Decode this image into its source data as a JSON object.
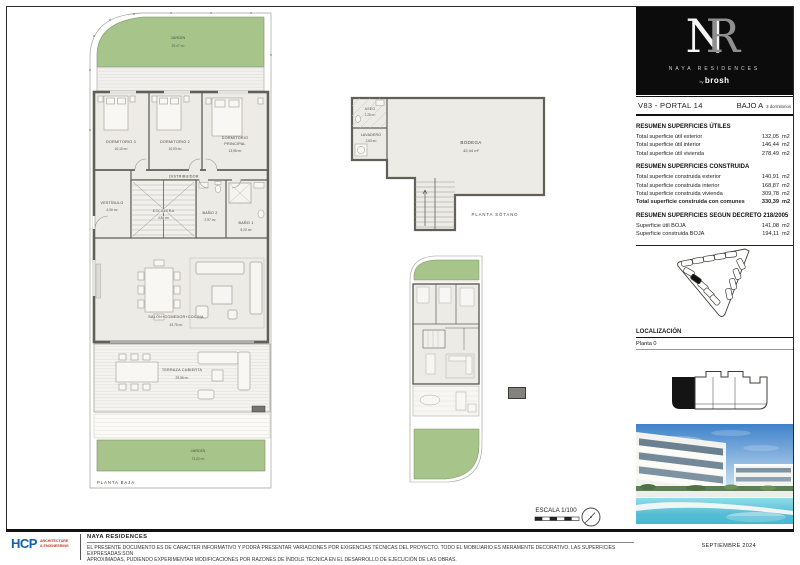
{
  "logo": {
    "monogram_n": "N",
    "monogram_r": "R",
    "brand": "NAYA RESIDENCES",
    "by": "by",
    "studio": "brosh"
  },
  "header": {
    "unit": "V83 - PORTAL 14",
    "floor": "BAJO A",
    "bedrooms": "3 dormitorios"
  },
  "tables": [
    {
      "title": "RESUMEN SUPERFICIES ÚTILES",
      "rows": [
        {
          "label": "Total superficie útil exterior",
          "value": "132,05",
          "unit": "m2"
        },
        {
          "label": "Total superficie útil interior",
          "value": "146,44",
          "unit": "m2"
        },
        {
          "label": "Total superficie útil vivienda",
          "value": "278,49",
          "unit": "m2"
        }
      ]
    },
    {
      "title": "RESUMEN SUPERFICIES CONSTRUIDA",
      "rows": [
        {
          "label": "Total superficie construida exterior",
          "value": "140,91",
          "unit": "m2"
        },
        {
          "label": "Total superficie construida interior",
          "value": "168,87",
          "unit": "m2"
        },
        {
          "label": "Total superficie construida vivienda",
          "value": "309,78",
          "unit": "m2"
        },
        {
          "label": "Total superficie construida con comunes",
          "value": "330,39",
          "unit": "m2"
        }
      ]
    },
    {
      "title": "RESUMEN SUPERFICIES SEGUN DECRETO 218/2005",
      "rows": [
        {
          "label": "Superficie útil BOJA",
          "value": "141,08",
          "unit": "m2"
        },
        {
          "label": "Superficie construida BOJA",
          "value": "194,11",
          "unit": "m2"
        }
      ]
    }
  ],
  "location": {
    "title": "LOCALIZACIÓN",
    "floor": "Planta  0"
  },
  "ground_floor": {
    "label": "PLANTA BAJA",
    "rooms": {
      "jardin_top": {
        "name": "JARDÍN",
        "area": "29,47 m²"
      },
      "dormitorio3": {
        "name": "DORMITORIO 3",
        "area": "10,10 m²"
      },
      "dormitorio2": {
        "name": "DORMITORIO 2",
        "area": "10,03 m²"
      },
      "dormitorio_principal": {
        "name": "DORMITORIO",
        "name2": "PRINCIPAL",
        "area": "13,95 m²"
      },
      "distribuidor": {
        "name": "DISTRIBUIDOR",
        "area": "3,25 m²"
      },
      "vestibulo": {
        "name": "VESTÍBULO",
        "area": "4,90 m²"
      },
      "escalera": {
        "name": "ESCALERA",
        "area": "4,84 m²"
      },
      "bano2": {
        "name": "BAÑO 2",
        "area": "2,97 m²"
      },
      "bano1": {
        "name": "BAÑO 1",
        "area": "5,20 m²"
      },
      "salon": {
        "name": "SALÓN+COMEDOR+COCINA",
        "area": "43,75 m²"
      },
      "terraza": {
        "name": "TERRAZA CUBIERTA",
        "area": "29,56 m²"
      },
      "jardin_bottom": {
        "name": "JARDÍN",
        "area": "73,02 m²"
      }
    }
  },
  "basement": {
    "label": "PLANTA SÓTANO",
    "rooms": {
      "aseo": {
        "name": "ASEO",
        "area": "2,28 m²"
      },
      "lavadero": {
        "name": "LAVADERO",
        "area": "2,63 m²"
      },
      "bodega": {
        "name": "BODEGA",
        "area": "42,44 m²"
      }
    }
  },
  "scale": {
    "label": "ESCALA 1/100"
  },
  "footer": {
    "firm": "HCP",
    "firm_line1": "ARCHITECTURE",
    "firm_line2": "& ENGINEERING",
    "project": "NAYA RESIDENCES",
    "disclaimer1": "EL PRESENTE DOCUMENTO ES DE CARACTER INFORMATIVO Y PODRÁ PRESENTAR VARIACIONES POR EXIGENCIAS TÉCNICAS DEL PROYECTO. TODO EL MOBILIARIO ES MERAMENTE DECORATIVO. LAS SUPERFICIES EXPRESADAS SON",
    "disclaimer2": "APROXIMADAS, PUDIENDO EXPERIMENTAR MODIFICACIONES POR RAZONES DE ÍNDOLE TÉCNICA EN EL DESARROLLO DE EJECUCIÓN DE LAS OBRAS.",
    "date": "SEPTIEMBRE 2024"
  },
  "colors": {
    "garden_green": "#a7c58b",
    "wall_gray": "#605f5a",
    "hcp_blue": "#1060aa",
    "hcp_red": "#c0392b",
    "sky_blue": "#3e82ca",
    "pool_cyan": "#37a8c6",
    "logo_black": "#0c0c0c"
  }
}
